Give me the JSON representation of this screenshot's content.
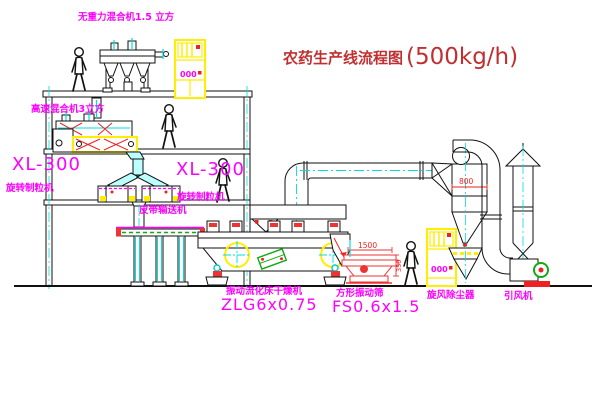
{
  "title": {
    "name": "农药生产线流程图",
    "capacity": "(500kg/h)"
  },
  "labels": {
    "gravity_mixer": "无重力混合机1.5 立方",
    "floor2_mixer": "高速混合机3立方",
    "granulator_left_model": "XL-300",
    "granulator_left_name": "旋转制粒机",
    "granulator_mid_model": "XL-300",
    "granulator_mid_name": "旋转制粒机",
    "belt_conveyor": "皮带输送机",
    "dryer_name": "振动流化床干燥机",
    "dryer_model": "ZLG6x0.75",
    "screen_name": "方形振动筛",
    "screen_model": "FS0.6x1.5",
    "cyclone": "旋风除尘器",
    "fan": "引风机"
  },
  "dimensions": {
    "cyclone_inlet_width": "800",
    "screen_length": "1500",
    "screen_side": "350"
  },
  "cabinet": {
    "panel_text": "000"
  },
  "colors": {
    "label": "#ff00ff",
    "title": "#c03030",
    "dimension": "#ee2222",
    "centerline": "#00dddd",
    "equipment_highlight": "#ffee00"
  }
}
